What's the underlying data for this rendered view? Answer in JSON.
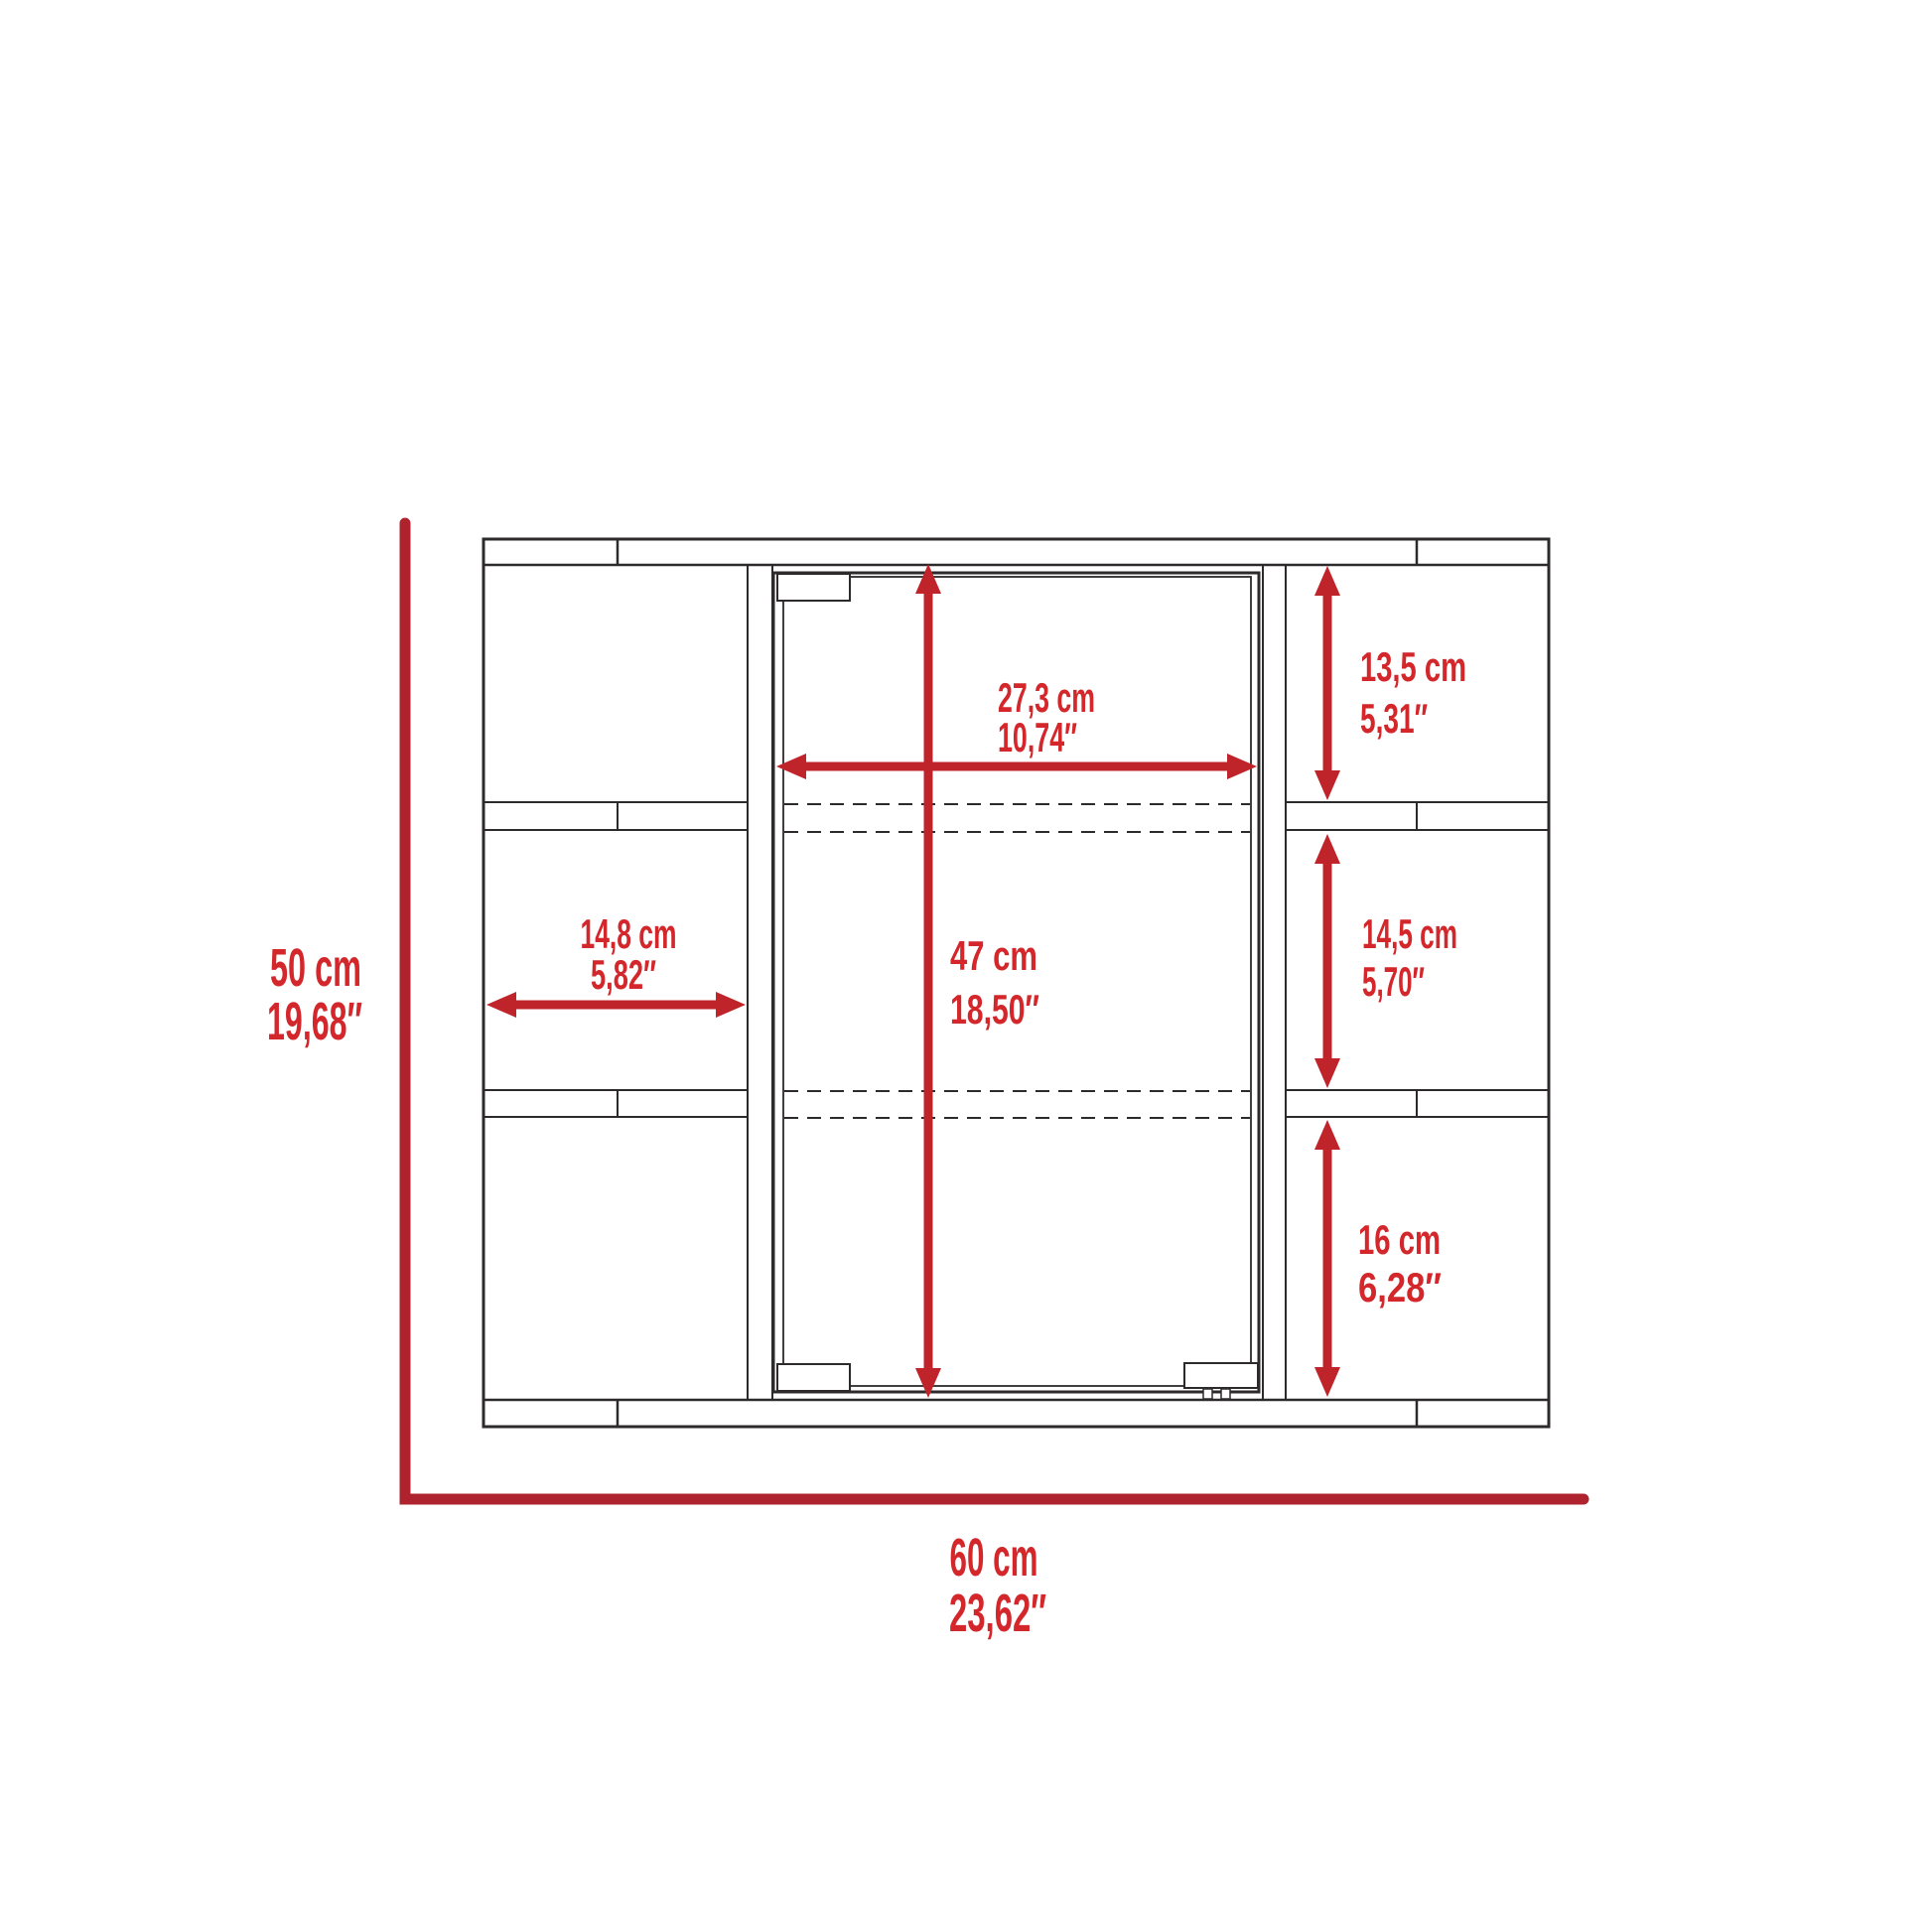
{
  "diagram": {
    "title": "cabinet-dimension-drawing",
    "overall": {
      "height_cm": "50 cm",
      "height_in": "19,68″",
      "width_cm": "60 cm",
      "width_in": "23,62″"
    },
    "mirror_door": {
      "width_cm": "27,3 cm",
      "width_in": "10,74″",
      "height_cm": "47 cm",
      "height_in": "18,50″"
    },
    "left_shelf": {
      "width_cm": "14,8 cm",
      "width_in": "5,82″"
    },
    "right_shelves": [
      {
        "height_cm": "13,5 cm",
        "height_in": "5,31″"
      },
      {
        "height_cm": "14,5 cm",
        "height_in": "5,70″"
      },
      {
        "height_cm": "16 cm",
        "height_in": "6,28″"
      }
    ],
    "colors": {
      "axis_red": "#ae232e",
      "arrow_red": "#c0242b",
      "text_red": "#d3272b",
      "line_black": "#2d2a2b",
      "background": "#ffffff"
    }
  }
}
